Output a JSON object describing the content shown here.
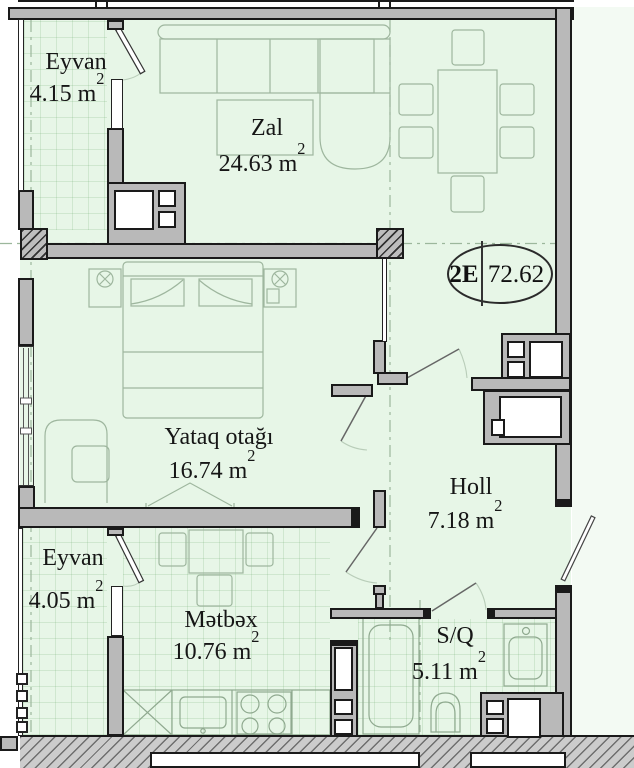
{
  "oval": {
    "code": "2E",
    "total": "72.62"
  },
  "rooms": [
    {
      "label": "Eyvan",
      "area": "4.15",
      "unit": "m",
      "sup": "2"
    },
    {
      "label": "Zal",
      "area": "24.63",
      "unit": "m",
      "sup": "2"
    },
    {
      "label": "Yataq otağı",
      "area": "16.74",
      "unit": "m",
      "sup": "2"
    },
    {
      "label": "Eyvan",
      "area": "4.05",
      "unit": "m",
      "sup": "2"
    },
    {
      "label": "Mətbəx",
      "area": "10.76",
      "unit": "m",
      "sup": "2"
    },
    {
      "label": "Holl",
      "area": "7.18",
      "unit": "m",
      "sup": "2"
    },
    {
      "label": "S/Q",
      "area": "5.11",
      "unit": "m",
      "sup": "2"
    }
  ],
  "colors": {
    "room_fill": "#e7f6e7",
    "wall_fill": "#b9b9b9",
    "wall_outline": "#1a1a1a",
    "hatch_fill": "#bdbdbd",
    "text": "#161616"
  }
}
